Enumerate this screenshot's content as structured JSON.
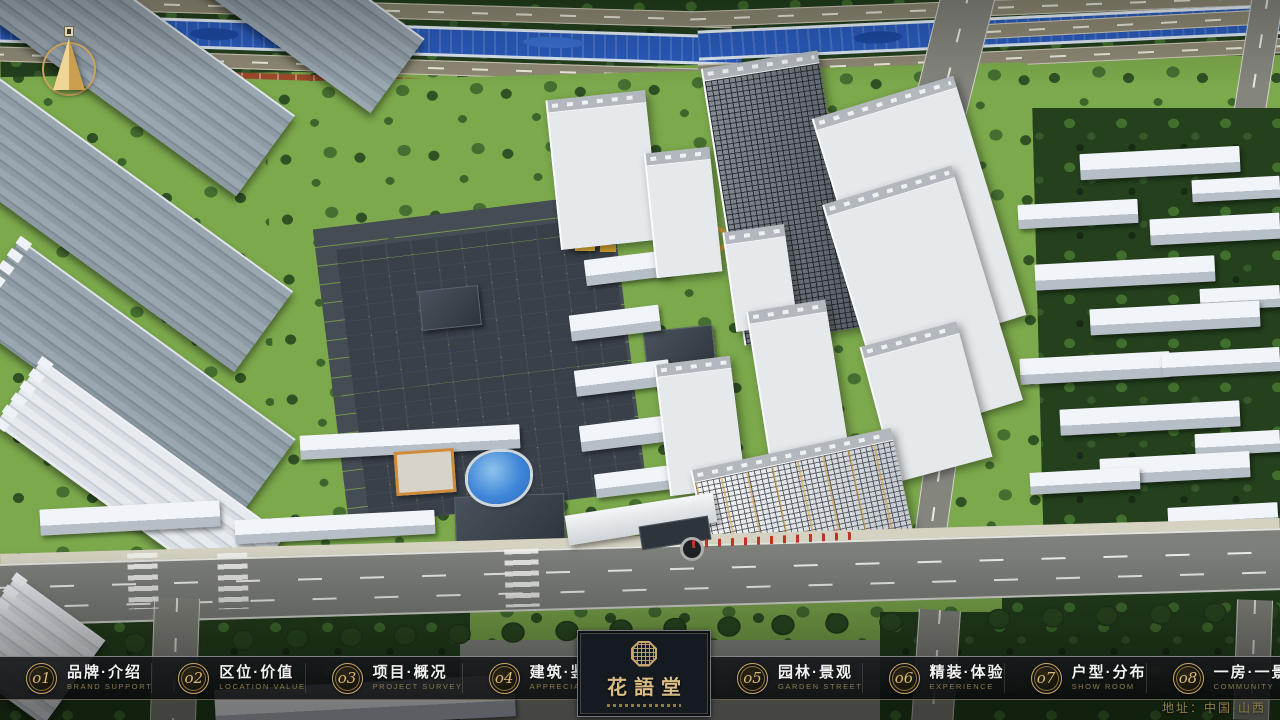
{
  "app": {
    "close_label": "✕"
  },
  "nav": {
    "items": [
      {
        "num": "o1",
        "label": "品牌·介绍",
        "sub": "BRAND SUPPORT"
      },
      {
        "num": "o2",
        "label": "区位·价值",
        "sub": "LOCATION VALUE"
      },
      {
        "num": "o3",
        "label": "项目·概况",
        "sub": "PROJECT SURVEY"
      },
      {
        "num": "o4",
        "label": "建筑·鉴赏",
        "sub": "APPRECIATION"
      },
      {
        "num": "o5",
        "label": "园林·景观",
        "sub": "GARDEN STREET"
      },
      {
        "num": "o6",
        "label": "精装·体验",
        "sub": "EXPERIENCE"
      },
      {
        "num": "o7",
        "label": "户型·分布",
        "sub": "SHOW ROOM"
      },
      {
        "num": "o8",
        "label": "一房·一景",
        "sub": "COMMUNITY"
      }
    ]
  },
  "logo": {
    "name": "花語堂"
  },
  "footer": {
    "address": "地址：中国·山西"
  },
  "scene": {
    "description": "aerial 3D masterplan render of residential development with river, roads, towers and gardens"
  },
  "colors": {
    "accent_gold": "#c9a96a",
    "nav_bg": "rgba(10,12,14,0.85)",
    "river_blue": "#2a5cbe",
    "lawn_green": "#7ca94c"
  }
}
